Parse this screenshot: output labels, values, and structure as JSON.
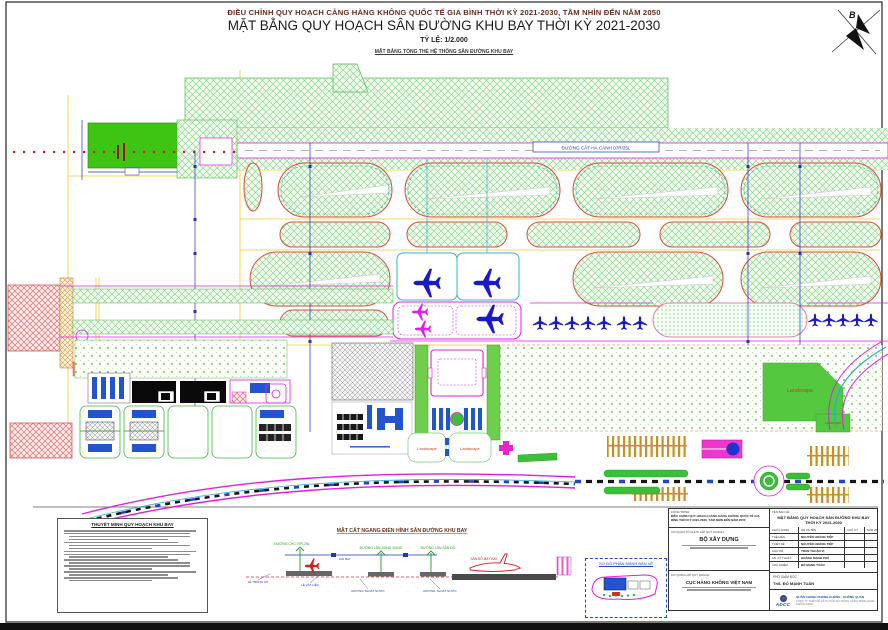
{
  "header": {
    "line1": "ĐIỀU CHỈNH QUY HOẠCH CẢNG HÀNG KHÔNG QUỐC TẾ GIA BÌNH THỜI KỲ 2021-2030, TẦM NHÌN ĐẾN NĂM 2050",
    "line2": "MẶT BẰNG QUY HOẠCH SÂN ĐƯỜNG KHU BAY THỜI KỲ 2021-2030",
    "scale": "TỶ LỆ: 1/2.000",
    "subtitle": "MẶT BẰNG TỔNG THỂ HỆ THỐNG SÂN ĐƯỜNG KHU BAY",
    "north": "B"
  },
  "plan": {
    "runway_label": "ĐƯỜNG CẤT HẠ CÁNH 07R/25L",
    "landscape": [
      "Landscape",
      "Landscape",
      "Landscape",
      "Landscape"
    ]
  },
  "legend": {
    "title": "THUYẾT MINH QUY HOẠCH KHU BAY"
  },
  "section": {
    "title": "MẶT CẮT NGANG ĐIỂN HÌNH SÂN ĐƯỜNG KHU BAY",
    "g1": "ĐƯỜNG CHC 07R-25L",
    "g2": "ĐƯỜNG LĂN SONG SONG",
    "g3": "ĐƯỜNG LĂN SÂN ĐỖ",
    "b1": "LỀ TRỒNG CỎ",
    "b2": "DẢI BAY",
    "b3": "LỀ VẬT LIỆU",
    "b4": "MƯƠNG THOÁT NƯỚC",
    "b5": "MƯƠNG THOÁT NƯỚC",
    "r1": "SÂN ĐỖ MÁY BAY"
  },
  "inset": {
    "title": "SƠ ĐỒ PHÂN MẢNH BẢN VẼ"
  },
  "title_block": {
    "project_label": "CÔNG TRÌNH:",
    "project_name": "ĐIỀU CHỈNH QUY HOẠCH CẢNG HÀNG KHÔNG QUỐC TẾ GIA BÌNH THỜI KỲ 2021-2030, TẦM NHÌN ĐẾN NĂM 2050",
    "drawing_label": "TÊN BẢN VẼ:",
    "drawing_name": "MẶT BẰNG QUY HOẠCH SÂN ĐƯỜNG KHU BAY THỜI KỲ 2021-2030",
    "org_label": "CƠ QUAN TỔ CHỨC LẬP QUY HOẠCH:",
    "org_name": "BỘ XÂY DỰNG",
    "agency_label": "CƠ QUAN LẬP QUY HOẠCH:",
    "agency_name": "CỤC HÀNG KHÔNG VIỆT NAM",
    "sign": {
      "h1": "CHỨC DANH",
      "h2": "HỌ VÀ TÊN",
      "h3": "CHỮ KÝ",
      "h4": "NĂM 2025",
      "rows": [
        {
          "role": "THỂ HIỆN",
          "name": "NGUYỄN HOÀNG TIỆP"
        },
        {
          "role": "THIẾT KẾ",
          "name": "NGUYỄN HOÀNG TIỆP"
        },
        {
          "role": "CHỦ TRÌ",
          "name": "TRẦN THUẬN VỊ"
        },
        {
          "role": "CN. KỸ THUẬT",
          "name": "HOÀNG MẠNH PHÚ"
        },
        {
          "role": "CHỦ NHIỆM",
          "name": "ĐỖ MẠNH TUẤN"
        }
      ]
    },
    "director_title": "PHÓ GIÁM ĐỐC",
    "director_name": "ThS. ĐỖ MẠNH TUẤN",
    "logo": "ADCC",
    "company1": "QUÂN CHỦNG PHÒNG KHÔNG - KHÔNG QUÂN",
    "company2": "CÔNG TY THIẾT KẾ VÀ TƯ VẤN XÂY DỰNG CÔNG TRÌNH HÀNG KHÔNG ADCC"
  },
  "colors": {
    "hatch_green": "#7fcf7f",
    "runway_green": "#3ec412",
    "magenta": "#e020e0",
    "plane_blue": "#1a1ac8",
    "landscape_label_red": "#d03a20",
    "adcc_blue": "#1a4fa0"
  }
}
